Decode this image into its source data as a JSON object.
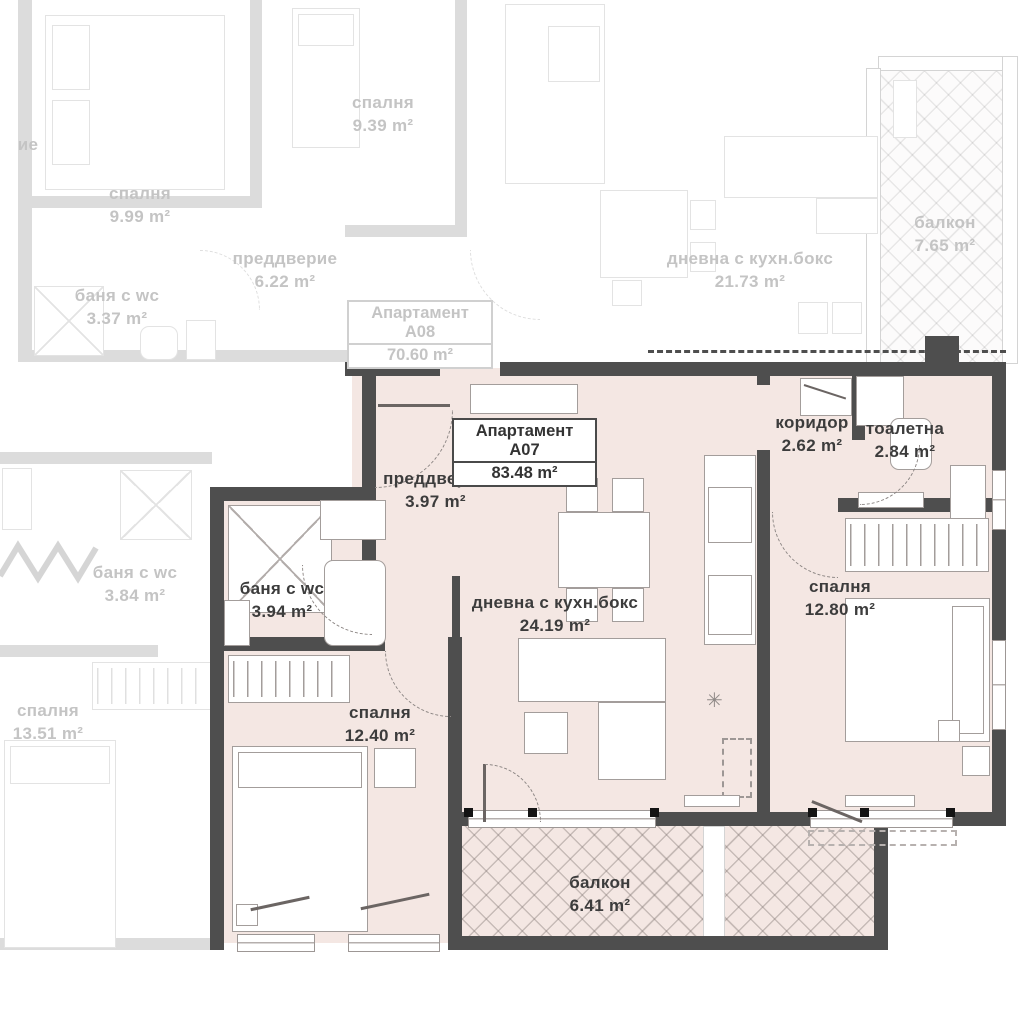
{
  "colors": {
    "wall_dark": "#4e4e4e",
    "fill_main": "#f4e7e3",
    "faded_text": "#c4c4c4",
    "text_dark": "#3c3c3c"
  },
  "apartments": {
    "a07": {
      "title": "Апартамент A07",
      "area": "83.48 m²",
      "rooms": {
        "vestibule": {
          "name": "преддверие",
          "area": "3.97 m²"
        },
        "bath": {
          "name": "баня с wc",
          "area": "3.94 m²"
        },
        "living": {
          "name": "дневна с кухн.бокс",
          "area": "24.19 m²"
        },
        "corridor": {
          "name": "коридор",
          "area": "2.62 m²"
        },
        "toilet": {
          "name": "тоалетна",
          "area": "2.84 m²"
        },
        "bedroom_right": {
          "name": "спалня",
          "area": "12.80 m²"
        },
        "bedroom_left": {
          "name": "спалня",
          "area": "12.40 m²"
        },
        "balcony": {
          "name": "балкон",
          "area": "6.41 m²"
        }
      }
    },
    "a08": {
      "title": "Апартамент A08",
      "area": "70.60 m²",
      "rooms": {
        "bedroom_left": {
          "name": "спалня",
          "area": "9.99 m²"
        },
        "bedroom_mid": {
          "name": "спалня",
          "area": "9.39 m²"
        },
        "vestibule": {
          "name": "преддверие",
          "area": "6.22 m²"
        },
        "bath": {
          "name": "баня с wc",
          "area": "3.37 m²"
        },
        "living": {
          "name": "дневна с кухн.бокс",
          "area": "21.73 m²"
        },
        "balcony": {
          "name": "балкон",
          "area": "7.65 m²"
        }
      }
    },
    "left_neighbor": {
      "clipped_label": "ие",
      "rooms": {
        "bath": {
          "name": "баня с wc",
          "area": "3.84 m²"
        },
        "bedroom": {
          "name": "спалня",
          "area": "13.51 m²"
        }
      }
    }
  }
}
